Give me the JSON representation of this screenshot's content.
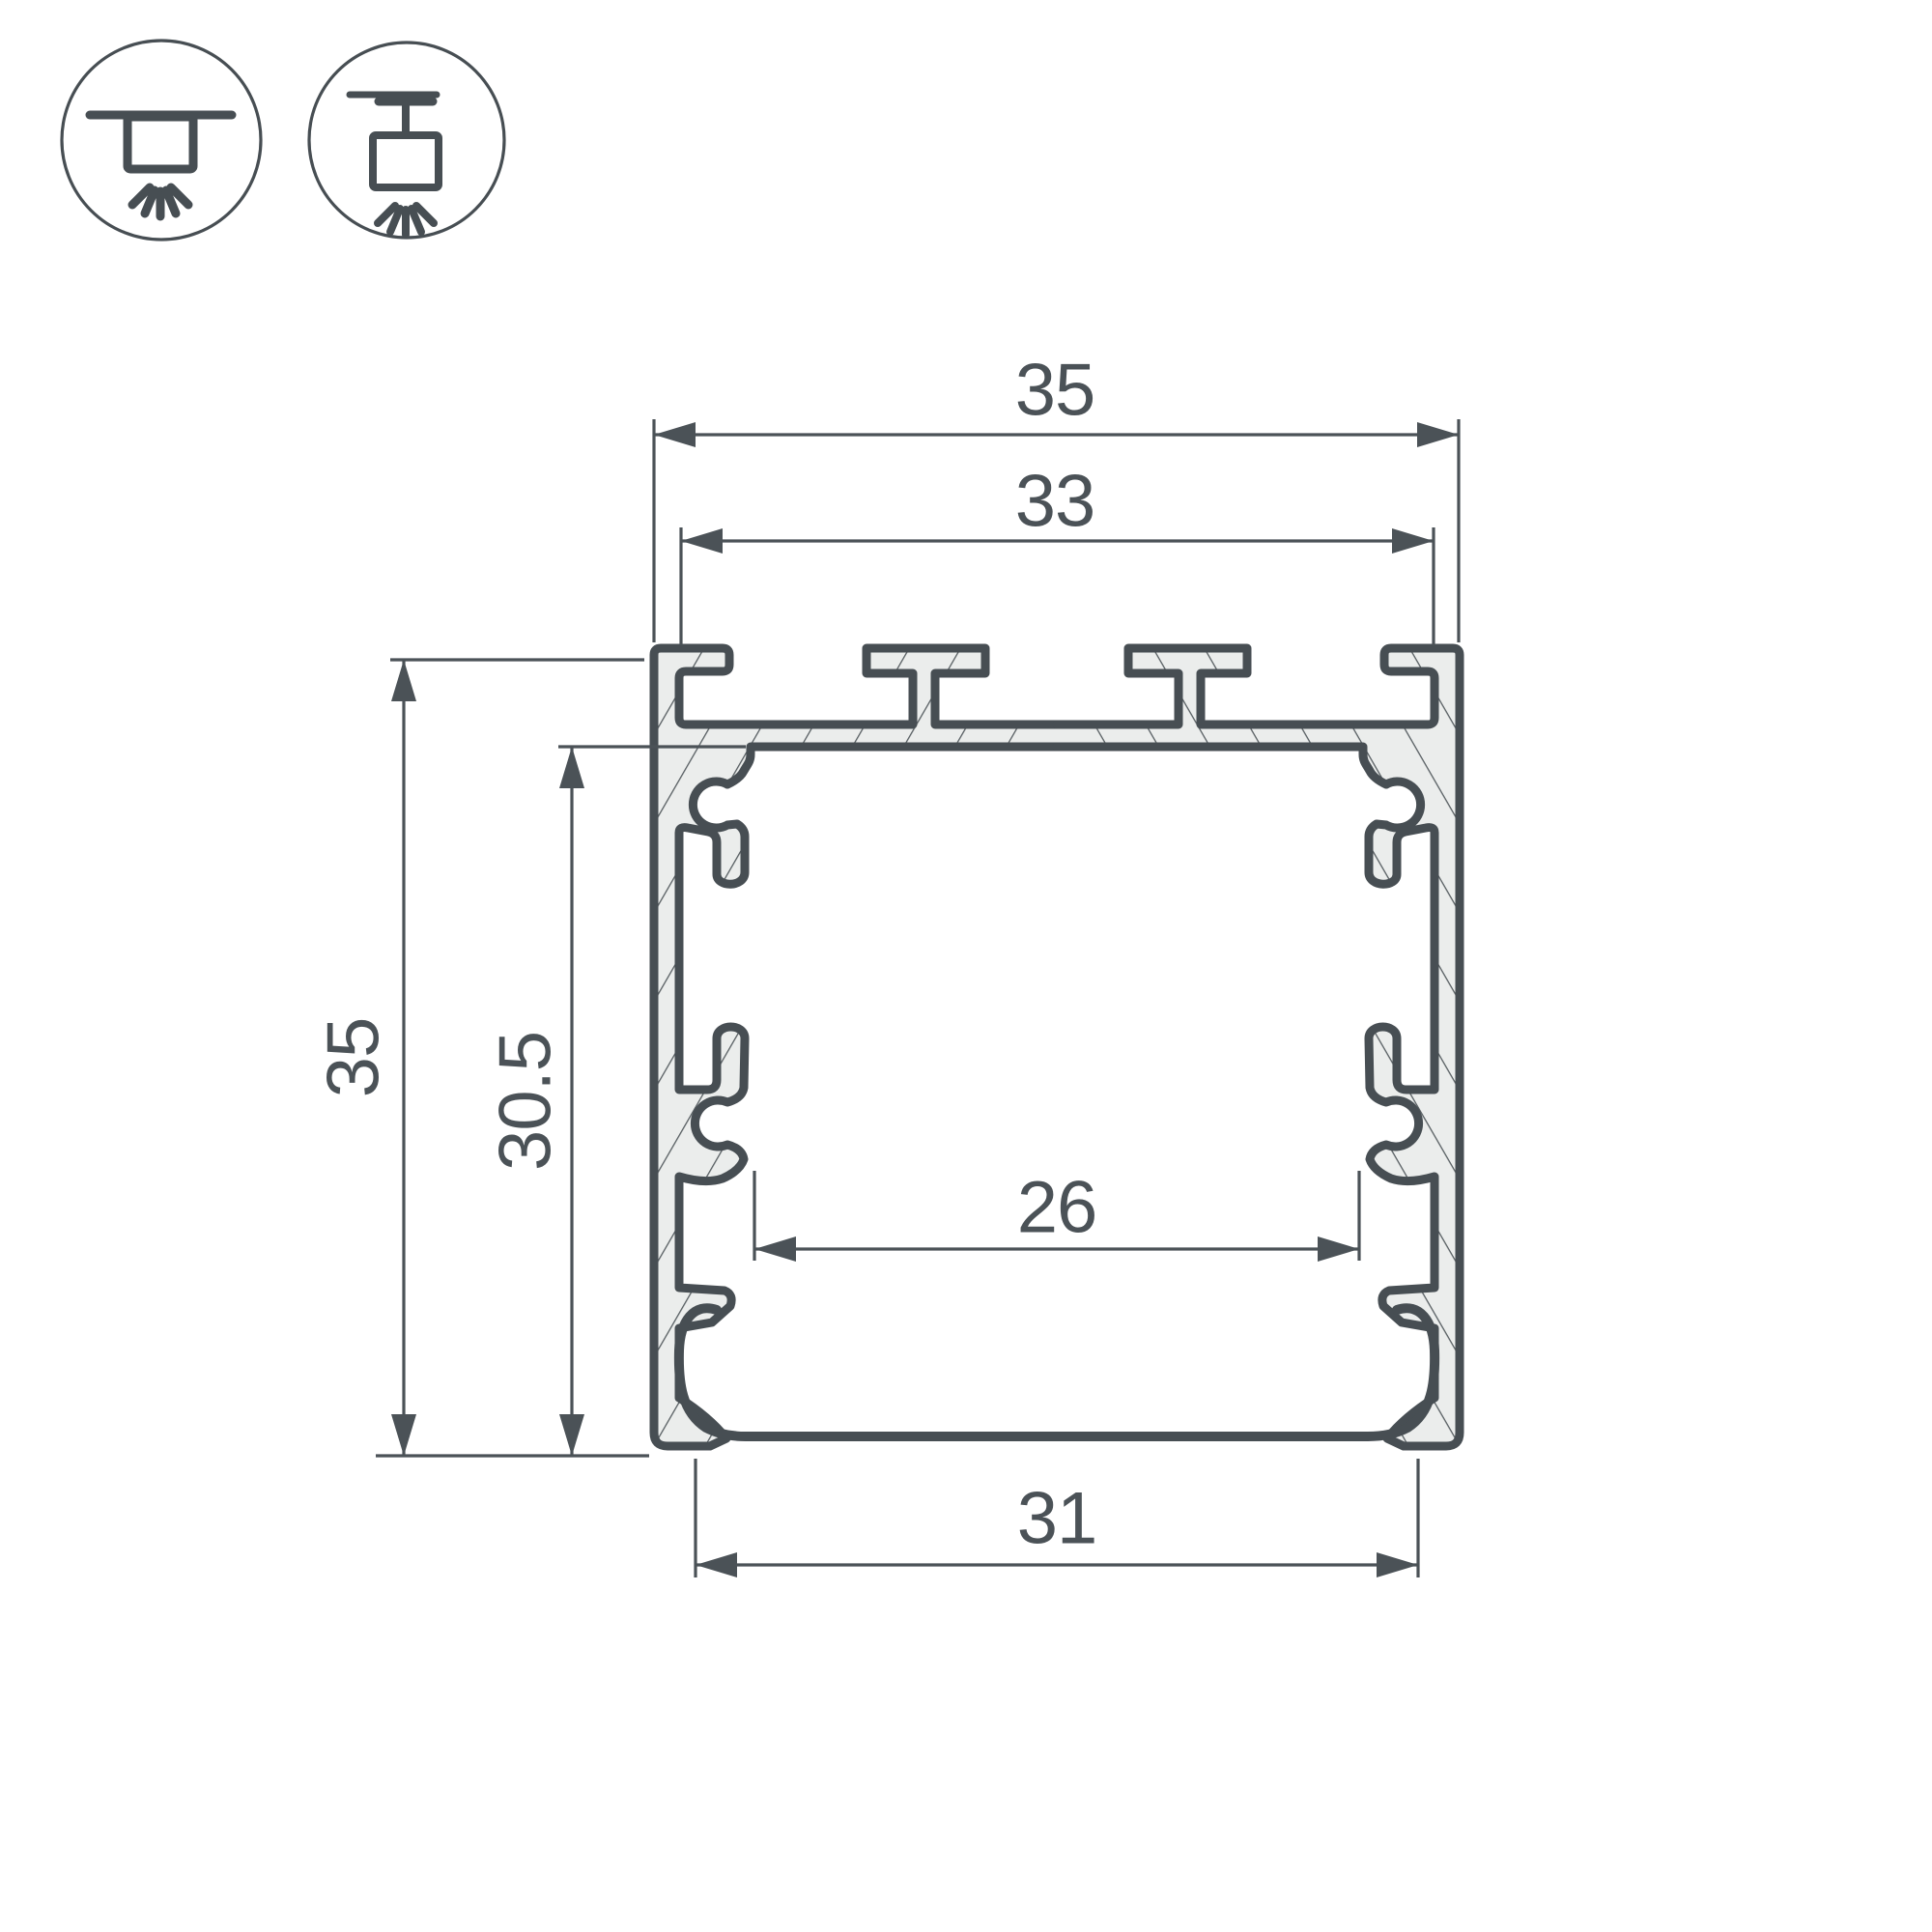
{
  "drawing": {
    "title": "led-profile-cross-section",
    "colors": {
      "outline": "#474E53",
      "dimension": "#4B5257",
      "metal_fill": "#EBEDEC",
      "hatch": "#565D61",
      "background": "#FFFFFF"
    },
    "dimensions": {
      "overall_width": "35",
      "top_slot_span": "33",
      "overall_height": "35",
      "inner_height": "30.5",
      "inner_width": "26",
      "bottom_width": "31"
    },
    "icons": [
      {
        "name": "surface-mount-icon"
      },
      {
        "name": "pendant-mount-icon"
      }
    ]
  }
}
